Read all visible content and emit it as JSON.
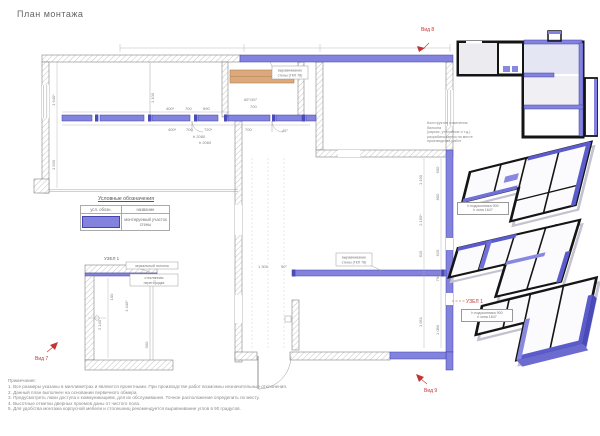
{
  "page": {
    "title": "План монтажа"
  },
  "colors": {
    "mounted_wall": "#8383de",
    "mounted_wall_dark": "#4a4ab8",
    "red_marks": "#c23535",
    "shelf_orange": "#dba97d"
  },
  "legend": {
    "title": "Условные обозначения",
    "header_symbol": "усл. обозн.",
    "header_name": "название",
    "row_name": "монтируемый участок стены"
  },
  "plan": {
    "callout_align_top": {
      "line1": "выравнивание",
      "line2": "стены (ГКЛ 78)"
    },
    "callout_align_mid": {
      "line1": "выравнивание",
      "line2": "стены (ГКЛ 78)"
    },
    "dims": {
      "rowA": [
        "400*",
        "700",
        "690"
      ],
      "closet_angle": "65°/45°",
      "closet_w": "700",
      "rowB": [
        "400*",
        "700",
        "720*",
        "700"
      ],
      "door_h1": "h 2080",
      "door_h2": "h 2060",
      "angle45": "45°",
      "left_v1": "1 940*",
      "left_v2": "1 530",
      "inner_v1": "1 100",
      "right_col1": [
        "1 190",
        "2 160*",
        "615",
        "1 951"
      ],
      "right_col2": [
        "600",
        "800",
        "615",
        "700",
        "1 080"
      ],
      "bottom_w": "1 300",
      "bottom_a": "90°"
    }
  },
  "detail": {
    "title": "УЗЕЛ 1",
    "callout_ceiling": "зеркальный потолок",
    "callout_partition_1": "стеклянная",
    "callout_partition_2": "перегородка",
    "dim_100": "100",
    "dim_1440": "1 440*",
    "dim_2140": "2 140",
    "dim_900": "900"
  },
  "views": {
    "arrow_view8": "Вид 8",
    "arrow_view7": "Вид 7",
    "arrow_view9": "Вид 9",
    "axon7": "Вид 7",
    "axon8": "Вид 8",
    "axon9": "Вид 9",
    "uzel_ref": "УЗЕЛ 1"
  },
  "callouts": {
    "balcony": [
      "Конструктив изменения балкона",
      "(каркас, утепление и т.д.)",
      "разрабатывается на месте",
      "производства работ"
    ],
    "window1": [
      "h подоконника 900",
      "h окна 1647"
    ],
    "window2": [
      "h подоконника 900",
      "h окна 1647"
    ]
  },
  "notes": {
    "heading": "Примечания:",
    "items": [
      "1. Все размеры указаны в миллиметрах и являются проектными. При производстве работ возможны незначительные отклонения.",
      "2. Данный план выполнен на основании первичного обмера.",
      "3. Предусмотреть люки доступа к коммуникациям, для их обслуживания. Точное расположение определить по месту.",
      "4. Высотные отметки дверных проемов даны от чистого пола.",
      "5. Для удобства монтажа корпусной мебели и столешниц рекомендуется выравнивание углов в 90 градусов."
    ]
  }
}
